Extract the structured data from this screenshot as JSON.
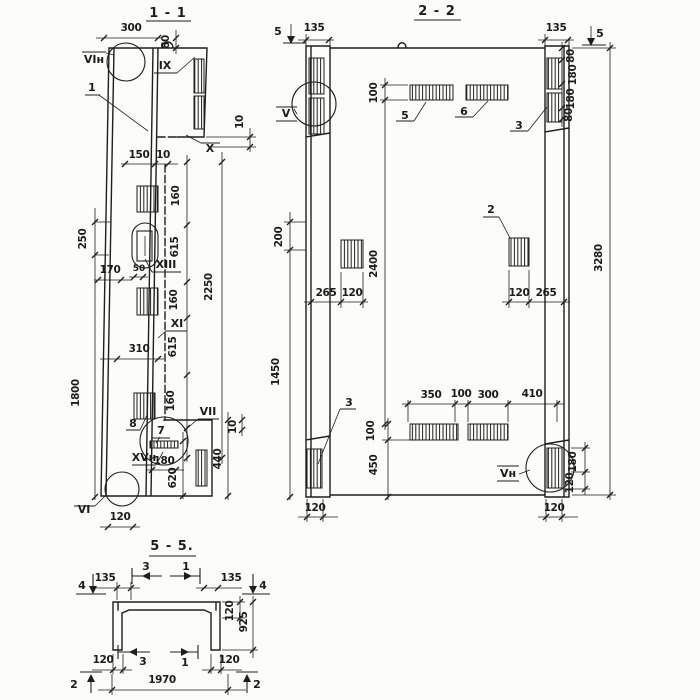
{
  "meta": {
    "background": "#fcfcfa",
    "ink": "#1c1c1c",
    "drawing_type": "structural panel sections"
  },
  "s11": {
    "title": "1 - 1",
    "labels": {
      "vin": "VIн",
      "ix": "IX",
      "x": "X",
      "xiii": "XIII",
      "xi": "XI",
      "vii": "VII",
      "xvn": "XVн",
      "vi": "VI"
    },
    "parts": {
      "p1": "1",
      "p7": "7",
      "p8": "8"
    },
    "dims": {
      "d300": "300",
      "d80": "80",
      "d10a": "10",
      "d150": "150",
      "d10b": "10",
      "d160a": "160",
      "d615a": "615",
      "d50": "50",
      "d2250": "2250",
      "d250": "250",
      "d170": "170",
      "d160b": "160",
      "d310": "310",
      "d615b": "615",
      "d1800": "1800",
      "d160c": "160",
      "d10c": "10",
      "d440": "440",
      "d180": "180",
      "d620": "620",
      "d120": "120"
    }
  },
  "s22": {
    "title": "2 - 2",
    "labels": {
      "v": "V",
      "vn": "Vн"
    },
    "marks": {
      "s5l": "5",
      "s5r": "5"
    },
    "parts": {
      "p2": "2",
      "p3t": "3",
      "p3b": "3",
      "p5": "5",
      "p6": "6"
    },
    "dims": {
      "d135l": "135",
      "d135r": "135",
      "d80a": "80",
      "d180a": "180",
      "d180b": "180",
      "d80b": "80",
      "d100t": "100",
      "d200": "200",
      "d2400": "2400",
      "d3280": "3280",
      "d265l": "265",
      "d120l": "120",
      "d120r": "120",
      "d265r": "265",
      "d1450": "1450",
      "d350": "350",
      "d100m": "100",
      "d300b": "300",
      "d410": "410",
      "d100b": "100",
      "d450": "450",
      "d180r": "180",
      "d120rb": "120",
      "d120bl": "120",
      "d120br": "120"
    }
  },
  "s55": {
    "title": "5 - 5.",
    "marks": {
      "m4l": "4",
      "m4r": "4",
      "m3t": "3",
      "m1t": "1",
      "m3b": "3",
      "m1b": "1",
      "m2l": "2",
      "m2r": "2"
    },
    "dims": {
      "d135l": "135",
      "d135r": "135",
      "d120r": "120",
      "d925": "925",
      "d120bl": "120",
      "d120br": "120",
      "d1970": "1970"
    }
  }
}
